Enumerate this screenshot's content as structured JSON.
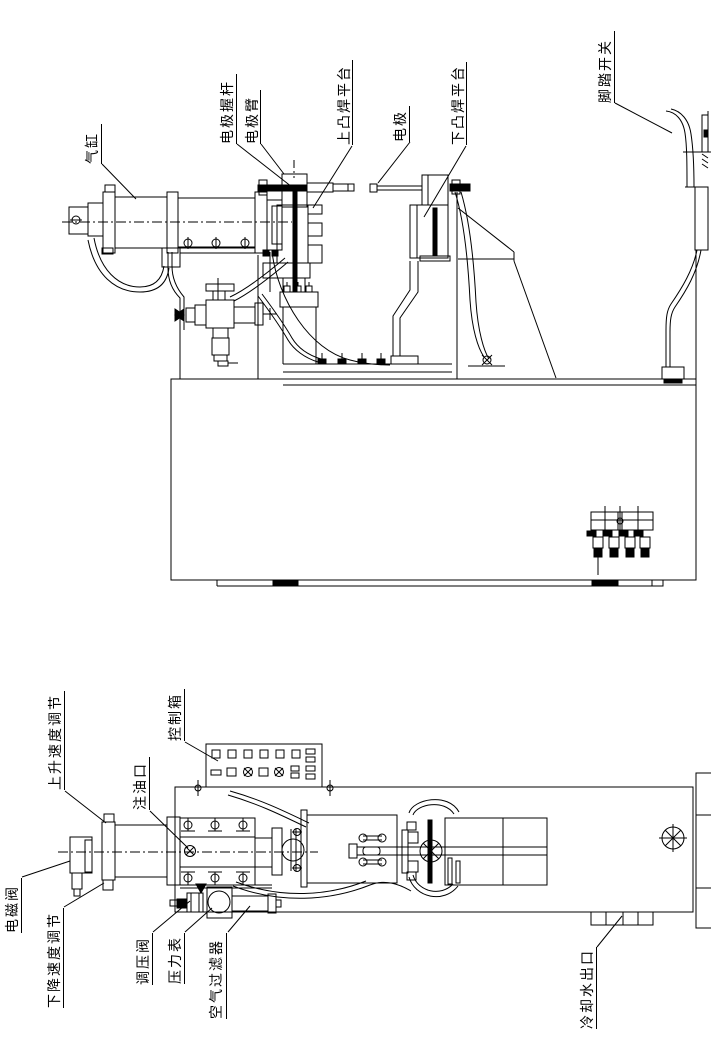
{
  "colors": {
    "background": "#ffffff",
    "line": "#000000"
  },
  "labels": [
    {
      "id": "air-cylinder",
      "text": "气缸"
    },
    {
      "id": "electrode-holder-rod",
      "text": "电极握杆"
    },
    {
      "id": "electrode-arm",
      "text": "电极臂"
    },
    {
      "id": "upper-projection-platform",
      "text": "上凸焊平台"
    },
    {
      "id": "electrode",
      "text": "电极"
    },
    {
      "id": "lower-projection-platform",
      "text": "下凸焊平台"
    },
    {
      "id": "foot-switch",
      "text": "脚踏开关"
    },
    {
      "id": "rise-speed-adjust",
      "text": "上升速度调节"
    },
    {
      "id": "control-box",
      "text": "控制箱"
    },
    {
      "id": "oil-fill-port",
      "text": "注油口"
    },
    {
      "id": "solenoid-valve",
      "text": "电磁阀"
    },
    {
      "id": "descent-speed-adjust",
      "text": "下降速度调节"
    },
    {
      "id": "pressure-regulator-valve",
      "text": "调压阀"
    },
    {
      "id": "pressure-gauge",
      "text": "压力表"
    },
    {
      "id": "air-filter",
      "text": "空气过滤器"
    },
    {
      "id": "cooling-water-outlet",
      "text": "冷却水出口"
    }
  ]
}
